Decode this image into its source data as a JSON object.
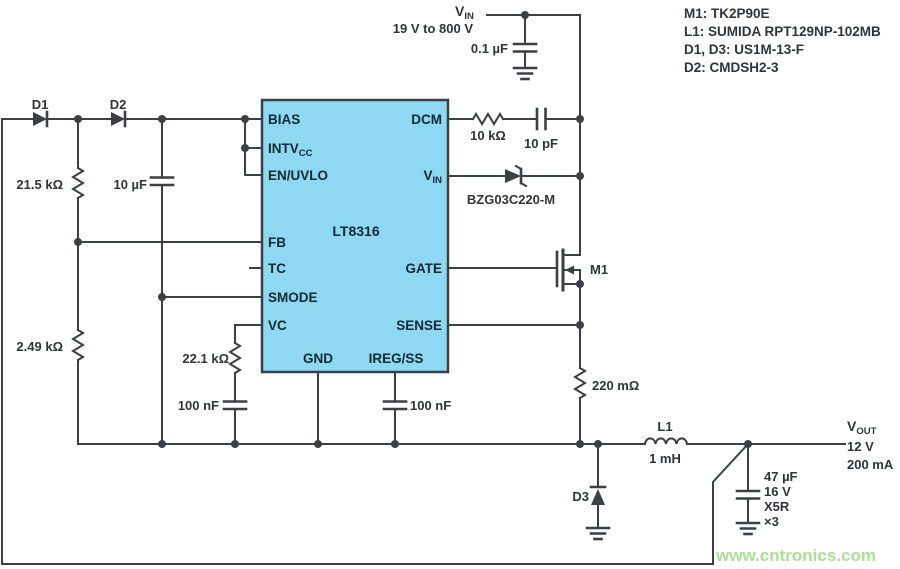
{
  "notes": [
    "M1: TK2P90E",
    "L1: SUMIDA RPT129NP-102MB",
    "D1, D3: US1M-13-F",
    "D2: CMDSH2-3"
  ],
  "watermark": "www.cntronics.com",
  "colors": {
    "wire": "#3b4046",
    "ic_fill": "#8ed8f2",
    "ic_text": "#122935",
    "label_text": "#303539",
    "watermark_green": "#a3dc8c"
  },
  "ic": {
    "name": "LT8316",
    "pins": {
      "bias": "BIAS",
      "intvcc_main": "INTV",
      "intvcc_sub": "CC",
      "en_uvlo": "EN/UVLO",
      "fb": "FB",
      "tc": "TC",
      "smode": "SMODE",
      "vc": "VC",
      "dcm": "DCM",
      "vin_main": "V",
      "vin_sub": "IN",
      "gate": "GATE",
      "sense": "SENSE",
      "gnd": "GND",
      "ireg_ss": "IREG/SS"
    }
  },
  "labels": {
    "vin_main": "V",
    "vin_sub": "IN",
    "vin_range": "19 V to 800 V",
    "c_in": "0.1 µF",
    "r_dcm": "10 kΩ",
    "c_dcm": "10 pF",
    "zener": "BZG03C220-M",
    "d1": "D1",
    "d2": "D2",
    "d3": "D3",
    "r_top": "21.5 kΩ",
    "c_bias": "10 µF",
    "r_bottom": "2.49 kΩ",
    "r_vc": "22.1 kΩ",
    "c_vc": "100 nF",
    "c_ss": "100 nF",
    "m1": "M1",
    "r_sense": "220 mΩ",
    "l1": "L1",
    "l1_value": "1 mH",
    "vout_main": "V",
    "vout_sub": "OUT",
    "vout_voltage": "12 V",
    "vout_current": "200 mA",
    "c_out_value": "47 µF",
    "c_out_rating": "16 V",
    "c_out_dielectric": "X5R",
    "c_out_qty": "×3"
  }
}
